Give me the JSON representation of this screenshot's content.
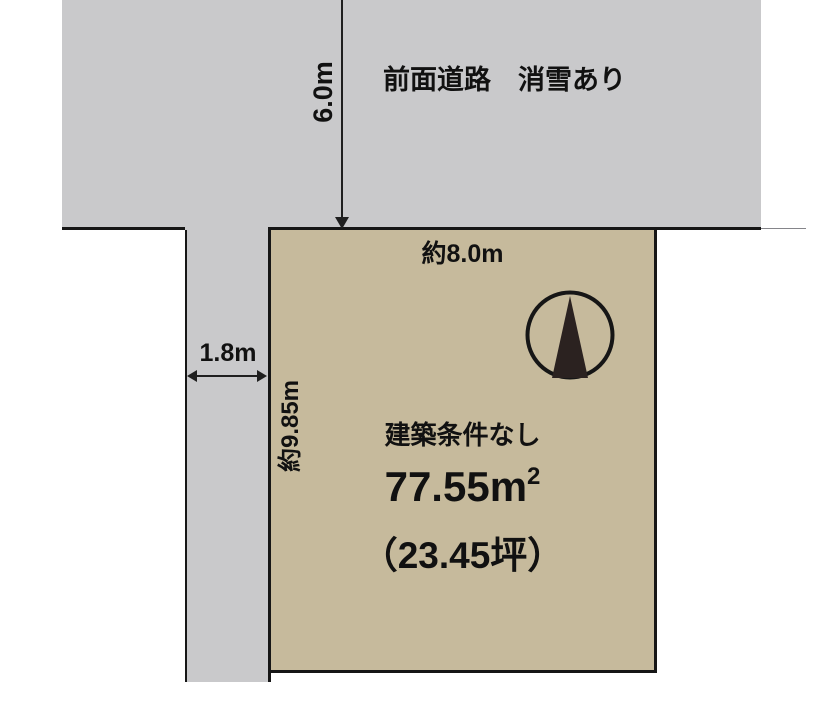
{
  "diagram": {
    "type": "land-plot-site-plan",
    "road": {
      "label": "前面道路　消雪あり",
      "width_dimension": "6.0m"
    },
    "side_path": {
      "width_dimension": "1.8m"
    },
    "parcel": {
      "frontage_dimension": "約8.0m",
      "depth_dimension": "約9.85m",
      "condition_label": "建築条件なし",
      "area_sqm_base": "77.55m",
      "area_sqm_exponent": "2",
      "area_tsubo": "（23.45坪）"
    },
    "compass": {
      "icon": "north-compass-icon"
    },
    "colors": {
      "road_fill": "#c9c9cb",
      "parcel_fill": "#c6ba9c",
      "outline": "#161616",
      "compass_needle": "#2b2220",
      "text": "#111111",
      "background": "#ffffff"
    }
  }
}
